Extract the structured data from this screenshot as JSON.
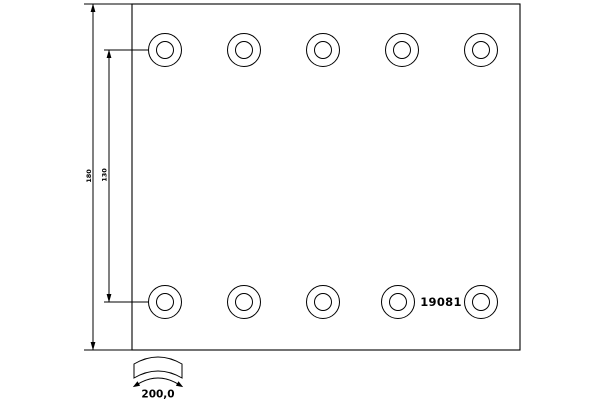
{
  "part_number": "19081",
  "dimensions": {
    "overall_height": "180",
    "hole_row_spacing": "130",
    "arc_length": "200,0"
  },
  "holes": {
    "rows": 2,
    "columns": 5,
    "total": 10
  },
  "icons": {
    "arc_length_symbol": "curved-lining-profile-with-double-arrow",
    "dimension_arrows": "filled-triangle-arrowheads"
  },
  "colors": {
    "line": "#000000",
    "background": "#ffffff",
    "text": "#000000"
  }
}
